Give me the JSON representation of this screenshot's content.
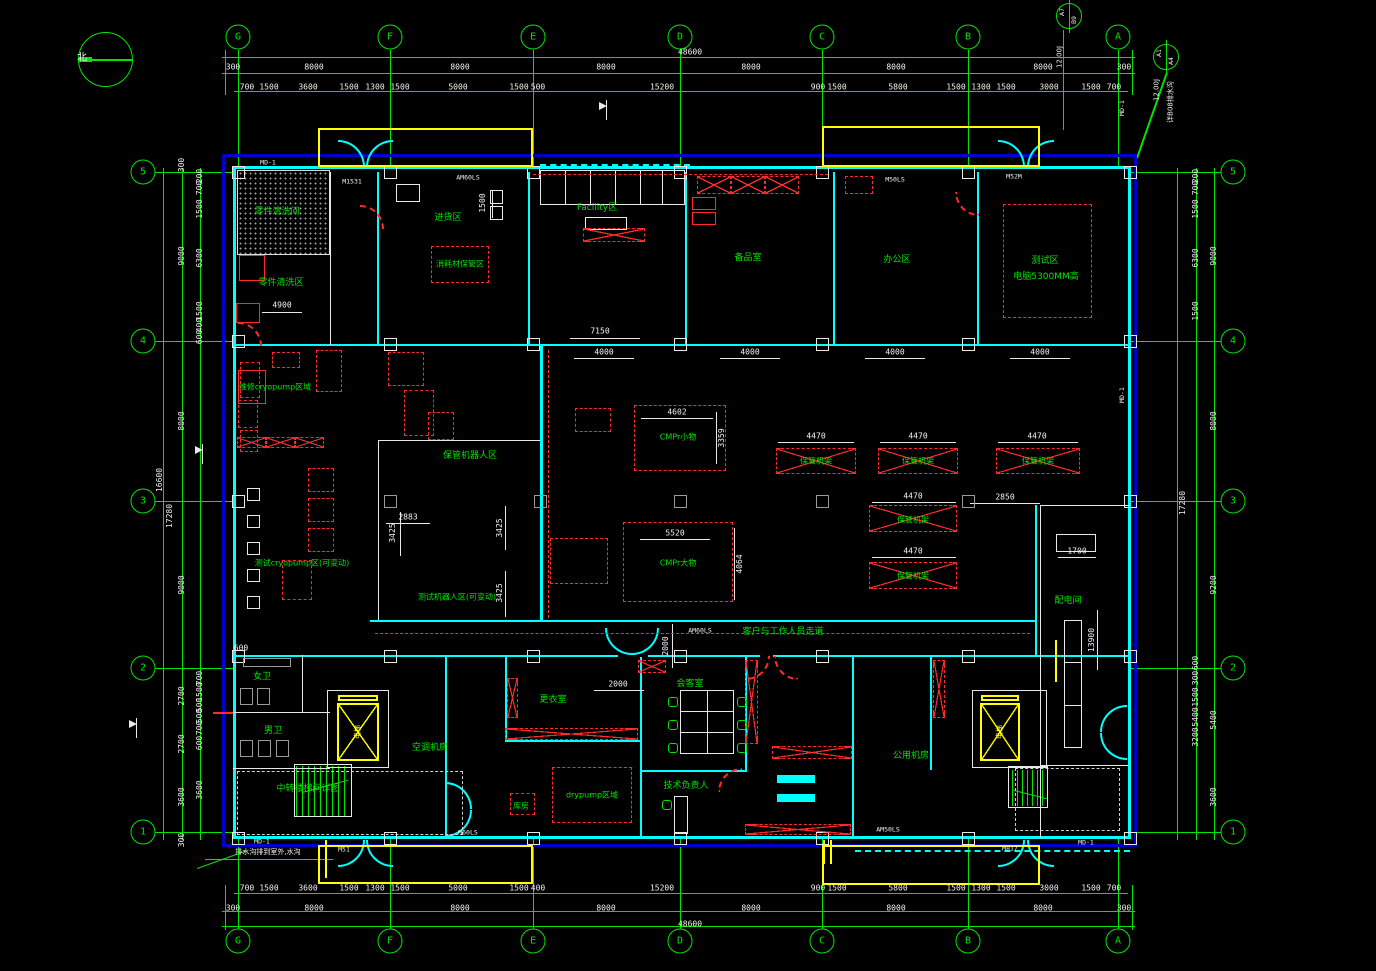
{
  "colors": {
    "background": "#000000",
    "grid_green": "#00e400",
    "wall_cyan": "#00ffff",
    "outer_border_blue": "#0000cc",
    "annotation_red": "#ff2a2a",
    "equipment_yellow": "#ffff00",
    "dimension_white": "#f2f2f2"
  },
  "compass": {
    "label": "北"
  },
  "grid": {
    "top": [
      {
        "id": "G",
        "x": 238
      },
      {
        "id": "F",
        "x": 390
      },
      {
        "id": "E",
        "x": 533
      },
      {
        "id": "D",
        "x": 680
      },
      {
        "id": "C",
        "x": 822
      },
      {
        "id": "B",
        "x": 968
      },
      {
        "id": "A",
        "x": 1118
      }
    ],
    "bottom": [
      {
        "id": "G",
        "x": 238
      },
      {
        "id": "F",
        "x": 390
      },
      {
        "id": "E",
        "x": 533
      },
      {
        "id": "D",
        "x": 680
      },
      {
        "id": "C",
        "x": 822
      },
      {
        "id": "B",
        "x": 968
      },
      {
        "id": "A",
        "x": 1118
      }
    ],
    "left": [
      {
        "id": "5",
        "y": 172
      },
      {
        "id": "4",
        "y": 341
      },
      {
        "id": "3",
        "y": 501
      },
      {
        "id": "2",
        "y": 668
      },
      {
        "id": "1",
        "y": 832
      }
    ],
    "right": [
      {
        "id": "5",
        "y": 172
      },
      {
        "id": "4",
        "y": 341
      },
      {
        "id": "3",
        "y": 501
      },
      {
        "id": "2",
        "y": 668
      },
      {
        "id": "1",
        "y": 832
      }
    ]
  },
  "dimensions": {
    "unit": "mm",
    "labels": [
      {
        "t": "48600",
        "x": 690,
        "y": 52
      },
      {
        "t": "48600",
        "x": 690,
        "y": 924
      },
      {
        "t": "300",
        "x": 233,
        "y": 67
      },
      {
        "t": "8000",
        "x": 314,
        "y": 67
      },
      {
        "t": "8000",
        "x": 460,
        "y": 67
      },
      {
        "t": "8000",
        "x": 606,
        "y": 67
      },
      {
        "t": "8000",
        "x": 751,
        "y": 67
      },
      {
        "t": "8000",
        "x": 896,
        "y": 67
      },
      {
        "t": "8000",
        "x": 1043,
        "y": 67
      },
      {
        "t": "300",
        "x": 1124,
        "y": 67
      },
      {
        "t": "700",
        "x": 247,
        "y": 87
      },
      {
        "t": "1500",
        "x": 269,
        "y": 87
      },
      {
        "t": "3600",
        "x": 308,
        "y": 87
      },
      {
        "t": "1500",
        "x": 349,
        "y": 87
      },
      {
        "t": "1300",
        "x": 375,
        "y": 87
      },
      {
        "t": "1500",
        "x": 400,
        "y": 87
      },
      {
        "t": "5000",
        "x": 458,
        "y": 87
      },
      {
        "t": "1500",
        "x": 519,
        "y": 87
      },
      {
        "t": "500",
        "x": 538,
        "y": 87
      },
      {
        "t": "15200",
        "x": 662,
        "y": 87
      },
      {
        "t": "900",
        "x": 818,
        "y": 87
      },
      {
        "t": "1500",
        "x": 837,
        "y": 87
      },
      {
        "t": "5800",
        "x": 898,
        "y": 87
      },
      {
        "t": "1500",
        "x": 956,
        "y": 87
      },
      {
        "t": "1300",
        "x": 981,
        "y": 87
      },
      {
        "t": "1500",
        "x": 1006,
        "y": 87
      },
      {
        "t": "3000",
        "x": 1049,
        "y": 87
      },
      {
        "t": "1500",
        "x": 1091,
        "y": 87
      },
      {
        "t": "700",
        "x": 1114,
        "y": 87
      },
      {
        "t": "300",
        "x": 233,
        "y": 908
      },
      {
        "t": "8000",
        "x": 314,
        "y": 908
      },
      {
        "t": "8000",
        "x": 460,
        "y": 908
      },
      {
        "t": "8000",
        "x": 606,
        "y": 908
      },
      {
        "t": "8000",
        "x": 751,
        "y": 908
      },
      {
        "t": "8000",
        "x": 896,
        "y": 908
      },
      {
        "t": "8000",
        "x": 1043,
        "y": 908
      },
      {
        "t": "300",
        "x": 1124,
        "y": 908
      },
      {
        "t": "700",
        "x": 247,
        "y": 888
      },
      {
        "t": "1500",
        "x": 269,
        "y": 888
      },
      {
        "t": "3600",
        "x": 308,
        "y": 888
      },
      {
        "t": "1500",
        "x": 349,
        "y": 888
      },
      {
        "t": "1300",
        "x": 375,
        "y": 888
      },
      {
        "t": "1500",
        "x": 400,
        "y": 888
      },
      {
        "t": "5000",
        "x": 458,
        "y": 888
      },
      {
        "t": "1500",
        "x": 519,
        "y": 888
      },
      {
        "t": "400",
        "x": 538,
        "y": 888
      },
      {
        "t": "15200",
        "x": 662,
        "y": 888
      },
      {
        "t": "900",
        "x": 818,
        "y": 888
      },
      {
        "t": "1500",
        "x": 837,
        "y": 888
      },
      {
        "t": "5800",
        "x": 898,
        "y": 888
      },
      {
        "t": "1500",
        "x": 956,
        "y": 888
      },
      {
        "t": "1300",
        "x": 981,
        "y": 888
      },
      {
        "t": "1500",
        "x": 1006,
        "y": 888
      },
      {
        "t": "3000",
        "x": 1049,
        "y": 888
      },
      {
        "t": "1500",
        "x": 1091,
        "y": 888
      },
      {
        "t": "700",
        "x": 1114,
        "y": 888
      },
      {
        "t": "300",
        "x": 182,
        "y": 165,
        "r": 1
      },
      {
        "t": "9000",
        "x": 182,
        "y": 256,
        "r": 1
      },
      {
        "t": "8000",
        "x": 182,
        "y": 421,
        "r": 1
      },
      {
        "t": "9000",
        "x": 182,
        "y": 585,
        "r": 1
      },
      {
        "t": "2700",
        "x": 182,
        "y": 696,
        "r": 1
      },
      {
        "t": "2700",
        "x": 182,
        "y": 744,
        "r": 1
      },
      {
        "t": "3600",
        "x": 182,
        "y": 797,
        "r": 1
      },
      {
        "t": "300",
        "x": 182,
        "y": 840,
        "r": 1
      },
      {
        "t": "200",
        "x": 200,
        "y": 176,
        "r": 1
      },
      {
        "t": "700",
        "x": 200,
        "y": 188,
        "r": 1
      },
      {
        "t": "1500",
        "x": 200,
        "y": 209,
        "r": 1
      },
      {
        "t": "6300",
        "x": 200,
        "y": 258,
        "r": 1
      },
      {
        "t": "1500",
        "x": 200,
        "y": 311,
        "r": 1
      },
      {
        "t": "400",
        "x": 200,
        "y": 325,
        "r": 1
      },
      {
        "t": "600",
        "x": 200,
        "y": 337,
        "r": 1
      },
      {
        "t": "700",
        "x": 200,
        "y": 678,
        "r": 1
      },
      {
        "t": "1500",
        "x": 200,
        "y": 692,
        "r": 1
      },
      {
        "t": "500",
        "x": 200,
        "y": 705,
        "r": 1
      },
      {
        "t": "500",
        "x": 200,
        "y": 716,
        "r": 1
      },
      {
        "t": "700",
        "x": 200,
        "y": 728,
        "r": 1
      },
      {
        "t": "600",
        "x": 200,
        "y": 743,
        "r": 1
      },
      {
        "t": "3600",
        "x": 200,
        "y": 790,
        "r": 1
      },
      {
        "t": "16600",
        "x": 160,
        "y": 480,
        "r": 1
      },
      {
        "t": "17280",
        "x": 170,
        "y": 516,
        "r": 1
      },
      {
        "t": "9000",
        "x": 1214,
        "y": 256,
        "r": 1
      },
      {
        "t": "8000",
        "x": 1214,
        "y": 421,
        "r": 1
      },
      {
        "t": "9200",
        "x": 1214,
        "y": 585,
        "r": 1
      },
      {
        "t": "5400",
        "x": 1214,
        "y": 720,
        "r": 1
      },
      {
        "t": "3600",
        "x": 1214,
        "y": 797,
        "r": 1
      },
      {
        "t": "600",
        "x": 1196,
        "y": 663,
        "r": 1
      },
      {
        "t": "300",
        "x": 1196,
        "y": 678,
        "r": 1
      },
      {
        "t": "1500",
        "x": 1196,
        "y": 697,
        "r": 1
      },
      {
        "t": "5400",
        "x": 1196,
        "y": 717,
        "r": 1
      },
      {
        "t": "3200",
        "x": 1196,
        "y": 737,
        "r": 1
      },
      {
        "t": "200",
        "x": 1196,
        "y": 176,
        "r": 1
      },
      {
        "t": "700",
        "x": 1196,
        "y": 188,
        "r": 1
      },
      {
        "t": "1500",
        "x": 1196,
        "y": 209,
        "r": 1
      },
      {
        "t": "6300",
        "x": 1196,
        "y": 258,
        "r": 1
      },
      {
        "t": "1500",
        "x": 1196,
        "y": 311,
        "r": 1
      },
      {
        "t": "17280",
        "x": 1183,
        "y": 503,
        "r": 1
      },
      {
        "t": "7150",
        "x": 600,
        "y": 331
      },
      {
        "t": "4000",
        "x": 604,
        "y": 352
      },
      {
        "t": "4000",
        "x": 750,
        "y": 352
      },
      {
        "t": "4000",
        "x": 895,
        "y": 352
      },
      {
        "t": "4000",
        "x": 1040,
        "y": 352
      },
      {
        "t": "1500",
        "x": 483,
        "y": 203,
        "r": 1
      },
      {
        "t": "4900",
        "x": 282,
        "y": 305
      },
      {
        "t": "4602",
        "x": 677,
        "y": 412
      },
      {
        "t": "3359",
        "x": 722,
        "y": 438,
        "r": 1
      },
      {
        "t": "5520",
        "x": 675,
        "y": 533
      },
      {
        "t": "4064",
        "x": 740,
        "y": 564,
        "r": 1
      },
      {
        "t": "2883",
        "x": 408,
        "y": 517
      },
      {
        "t": "3425",
        "x": 393,
        "y": 533,
        "r": 1
      },
      {
        "t": "3425",
        "x": 500,
        "y": 528,
        "r": 1
      },
      {
        "t": "3425",
        "x": 500,
        "y": 593,
        "r": 1
      },
      {
        "t": "4470",
        "x": 816,
        "y": 436
      },
      {
        "t": "4470",
        "x": 918,
        "y": 436
      },
      {
        "t": "4470",
        "x": 1037,
        "y": 436
      },
      {
        "t": "4470",
        "x": 913,
        "y": 496
      },
      {
        "t": "4470",
        "x": 913,
        "y": 551
      },
      {
        "t": "2850",
        "x": 1005,
        "y": 497
      },
      {
        "t": "2000",
        "x": 618,
        "y": 684
      },
      {
        "t": "2000",
        "x": 666,
        "y": 646,
        "r": 1
      },
      {
        "t": "1700",
        "x": 1077,
        "y": 551
      },
      {
        "t": "13900",
        "x": 1092,
        "y": 640,
        "r": 1
      },
      {
        "t": "600",
        "x": 241,
        "y": 648
      }
    ]
  },
  "rooms": [
    {
      "name": "零件清洗间",
      "x": 277,
      "y": 212
    },
    {
      "name": "零件清洗区",
      "x": 281,
      "y": 283
    },
    {
      "name": "进货区",
      "x": 448,
      "y": 218
    },
    {
      "name": "Facility区",
      "x": 597,
      "y": 208
    },
    {
      "name": "备品室",
      "x": 748,
      "y": 258
    },
    {
      "name": "办公区",
      "x": 897,
      "y": 260
    },
    {
      "name": "测试区",
      "x": 1045,
      "y": 261
    },
    {
      "name": "电脑5300MM高",
      "x": 1046,
      "y": 277
    },
    {
      "name": "维修cryopump区域",
      "x": 275,
      "y": 387
    },
    {
      "name": "测试cryopump区(可变动)",
      "x": 302,
      "y": 563
    },
    {
      "name": "保管机器人区",
      "x": 470,
      "y": 456
    },
    {
      "name": "测试机器人区(可变动)",
      "x": 457,
      "y": 597
    },
    {
      "name": "配电间",
      "x": 1068,
      "y": 601
    },
    {
      "name": "客户与工作人员走道",
      "x": 783,
      "y": 632
    },
    {
      "name": "女卫",
      "x": 262,
      "y": 677
    },
    {
      "name": "男卫",
      "x": 273,
      "y": 731
    },
    {
      "name": "会客室",
      "x": 690,
      "y": 684
    },
    {
      "name": "技术负责人",
      "x": 686,
      "y": 786
    },
    {
      "name": "空调机房",
      "x": 430,
      "y": 748
    },
    {
      "name": "公用机房",
      "x": 911,
      "y": 756
    },
    {
      "name": "更衣室",
      "x": 553,
      "y": 700
    },
    {
      "name": "中转楼梯间详图",
      "x": 308,
      "y": 789
    }
  ],
  "equipment_zones": [
    {
      "name": "消耗材保管区",
      "x": 460,
      "y": 264
    },
    {
      "name": "CMPr小物",
      "x": 678,
      "y": 437
    },
    {
      "name": "CMPr大物",
      "x": 678,
      "y": 563
    },
    {
      "name": "保管机架",
      "x": 816,
      "y": 461
    },
    {
      "name": "保管机架",
      "x": 918,
      "y": 461
    },
    {
      "name": "保管机架",
      "x": 1038,
      "y": 461
    },
    {
      "name": "保管机架",
      "x": 913,
      "y": 520
    },
    {
      "name": "保管机架",
      "x": 913,
      "y": 576
    },
    {
      "name": "drypump区域",
      "x": 592,
      "y": 795
    },
    {
      "name": "库房",
      "x": 521,
      "y": 806
    }
  ],
  "annotations": [
    {
      "t": "12.00J",
      "x": 1060,
      "y": 57,
      "r": 1
    },
    {
      "t": "12.00J",
      "x": 1157,
      "y": 90,
      "r": 1
    },
    {
      "t": "详B08排水沟",
      "x": 1171,
      "y": 102,
      "r": 1
    },
    {
      "t": "排水沟排到室外,水沟",
      "x": 268,
      "y": 852
    }
  ],
  "elevators": [
    {
      "label": "电梯",
      "x": 358,
      "y": 732
    },
    {
      "label": "电梯",
      "x": 1000,
      "y": 732
    }
  ],
  "section_markers": [
    {
      "top": "A7",
      "bottom": "B9",
      "x": 1069,
      "y": 16
    },
    {
      "top": "A1",
      "bottom": "A4",
      "x": 1166,
      "y": 57
    }
  ],
  "wall_tags": [
    {
      "t": "MD-1",
      "x": 268,
      "y": 163
    },
    {
      "t": "M1531",
      "x": 352,
      "y": 182
    },
    {
      "t": "AM60LS",
      "x": 468,
      "y": 178
    },
    {
      "t": "M50LS",
      "x": 895,
      "y": 180
    },
    {
      "t": "M52M",
      "x": 1014,
      "y": 177
    },
    {
      "t": "MD-1",
      "x": 1122,
      "y": 108,
      "r": 1
    },
    {
      "t": "MD-1",
      "x": 1122,
      "y": 395,
      "r": 1
    },
    {
      "t": "MD-1",
      "x": 262,
      "y": 842
    },
    {
      "t": "M51",
      "x": 344,
      "y": 850
    },
    {
      "t": "M60LS",
      "x": 468,
      "y": 833
    },
    {
      "t": "AM60LS",
      "x": 700,
      "y": 631
    },
    {
      "t": "AM50LS",
      "x": 888,
      "y": 830
    },
    {
      "t": "M817",
      "x": 1010,
      "y": 849
    },
    {
      "t": "MD-1",
      "x": 1086,
      "y": 843
    }
  ]
}
